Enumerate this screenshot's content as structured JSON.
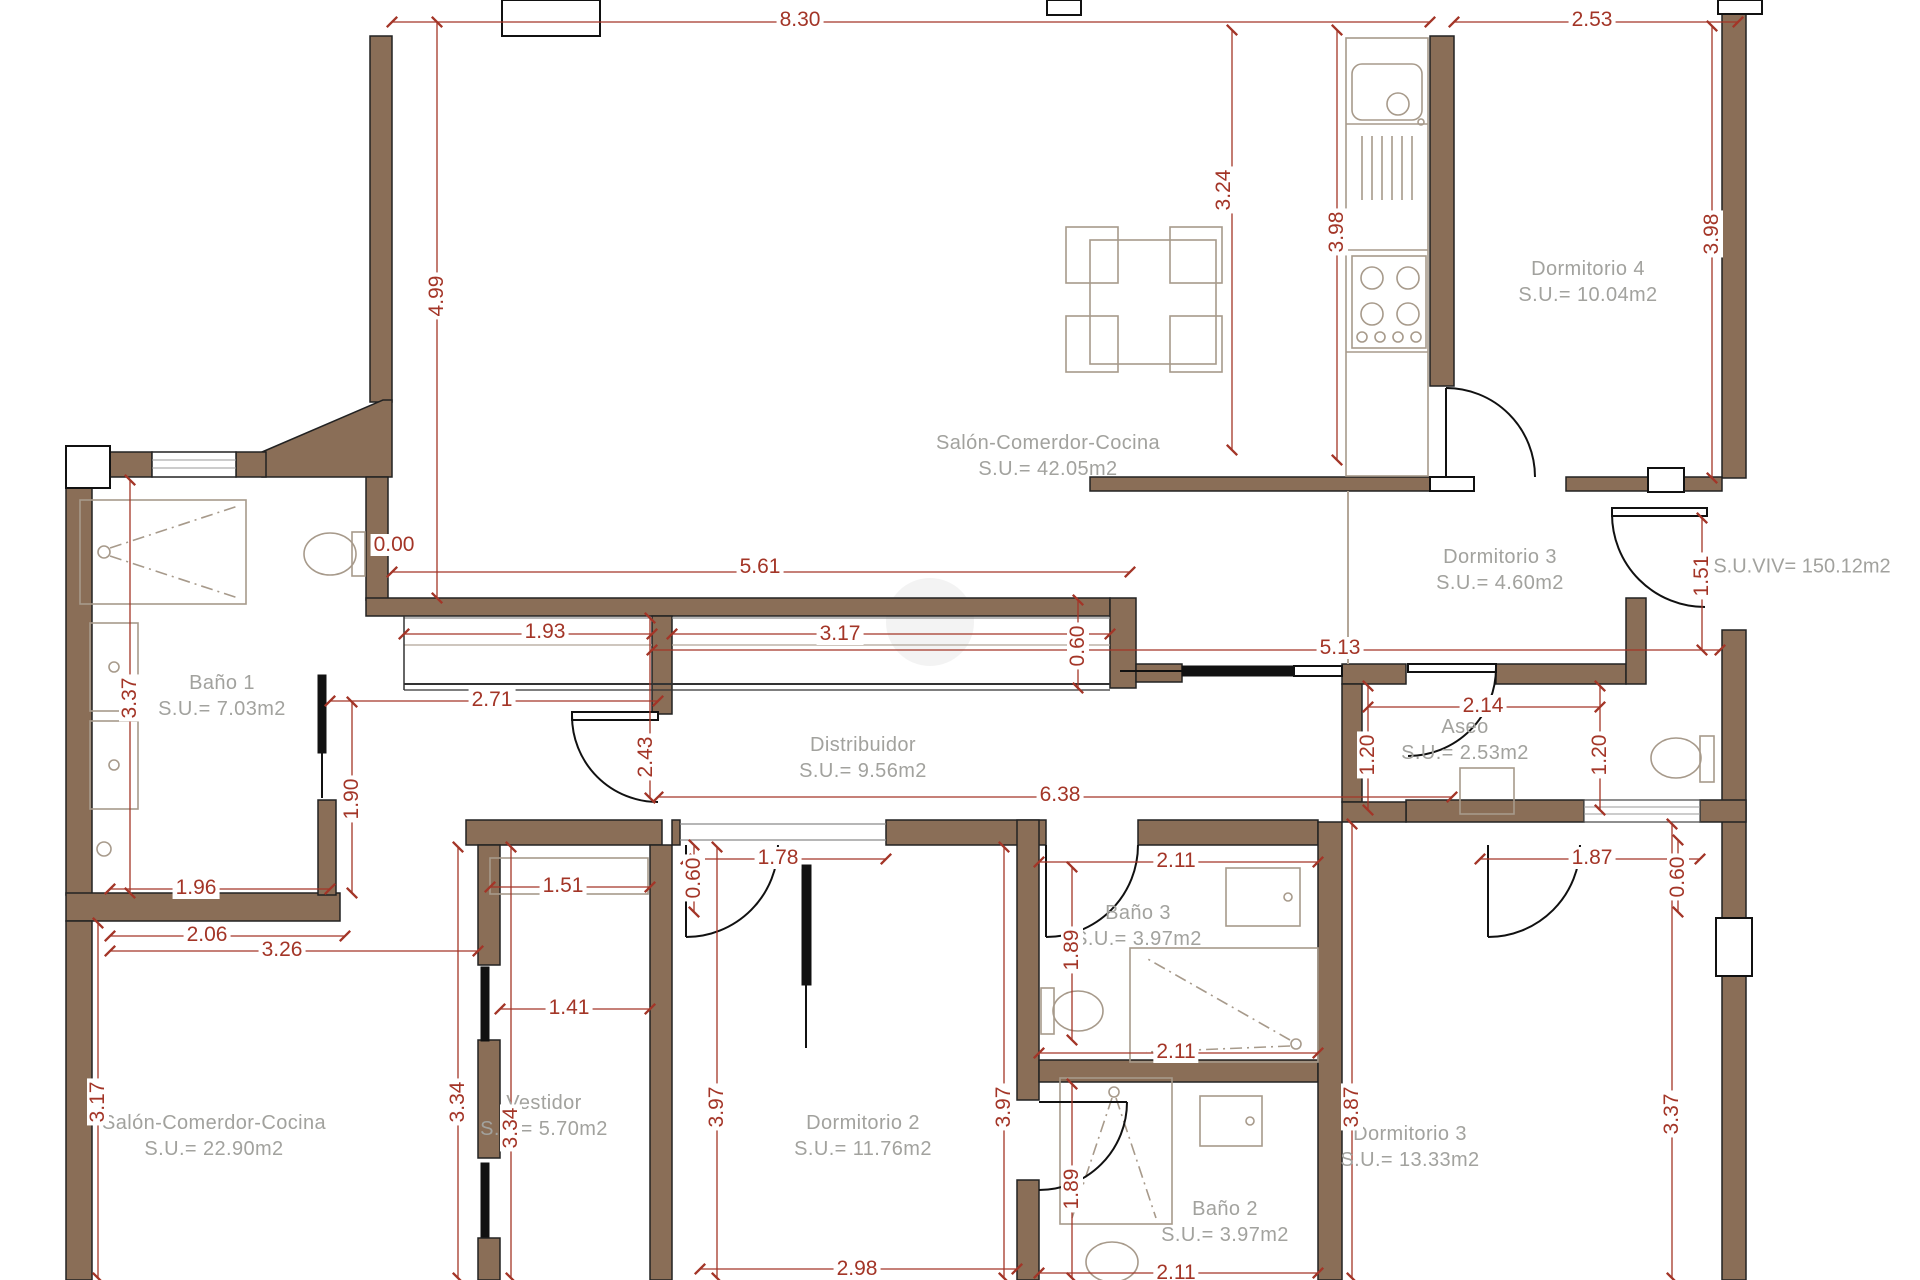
{
  "title": "floor-plan",
  "colors": {
    "wall_fill": "#8a6e57",
    "wall_stroke": "#222222",
    "dimension_red": "#a33527",
    "room_label_grey": "#a2a29e",
    "fixture_grey": "#a79a8b"
  },
  "rooms": {
    "salon_top": {
      "name": "Salón-Comerdor-Cocina",
      "area": "S.U.= 42.05m2"
    },
    "dorm4": {
      "name": "Dormitorio 4",
      "area": "S.U.= 10.04m2"
    },
    "dorm3u": {
      "name": "Dormitorio 3",
      "area": "S.U.= 4.60m2"
    },
    "bano1": {
      "name": "Baño 1",
      "area": "S.U.= 7.03m2"
    },
    "distrib": {
      "name": "Distribuidor",
      "area": "S.U.= 9.56m2"
    },
    "aseo": {
      "name": "Aseo",
      "area": "S.U.= 2.53m2"
    },
    "salon_bot": {
      "name": "Salón-Comerdor-Cocina",
      "area": "S.U.= 22.90m2"
    },
    "vestidor": {
      "name": "Vestidor",
      "area": "S.U.= 5.70m2"
    },
    "dorm2": {
      "name": "Dormitorio 2",
      "area": "S.U.= 11.76m2"
    },
    "bano3": {
      "name": "Baño 3",
      "area": "S.U.= 3.97m2"
    },
    "bano2": {
      "name": "Baño 2",
      "area": "S.U.= 3.97m2"
    },
    "dorm3b": {
      "name": "Dormitorio 3",
      "area": "S.U.= 13.33m2"
    }
  },
  "summary": {
    "suviv": "S.U.VIV= 150.12m2"
  },
  "dims": {
    "d1": "8.30",
    "d2": "2.53",
    "d3": "4.99",
    "d4": "3.24",
    "d5": "3.98",
    "d6": "3.98",
    "d7": "0.00",
    "d8": "5.61",
    "d9": "1.93",
    "d10": "3.17",
    "d11": "0.60",
    "d12": "5.13",
    "d13": "2.71",
    "d14": "3.37",
    "d15": "1.90",
    "d16": "2.43",
    "d17": "6.38",
    "d18": "2.14",
    "d19": "1.20",
    "d20": "1.20",
    "d21": "1.51",
    "d22": "1.96",
    "d23": "2.06",
    "d24": "3.26",
    "d25": "1.51",
    "d26": "1.78",
    "d27": "0.60",
    "d28": "2.11",
    "d29": "1.87",
    "d30": "0.60",
    "d31": "1.41",
    "d32": "1.89",
    "d33": "2.11",
    "d34": "3.17",
    "d35": "3.34",
    "d36": "3.34",
    "d37": "3.97",
    "d38": "3.97",
    "d39": "3.87",
    "d40": "3.37",
    "d41": "1.89",
    "d42": "2.98",
    "d43": "2.11"
  }
}
